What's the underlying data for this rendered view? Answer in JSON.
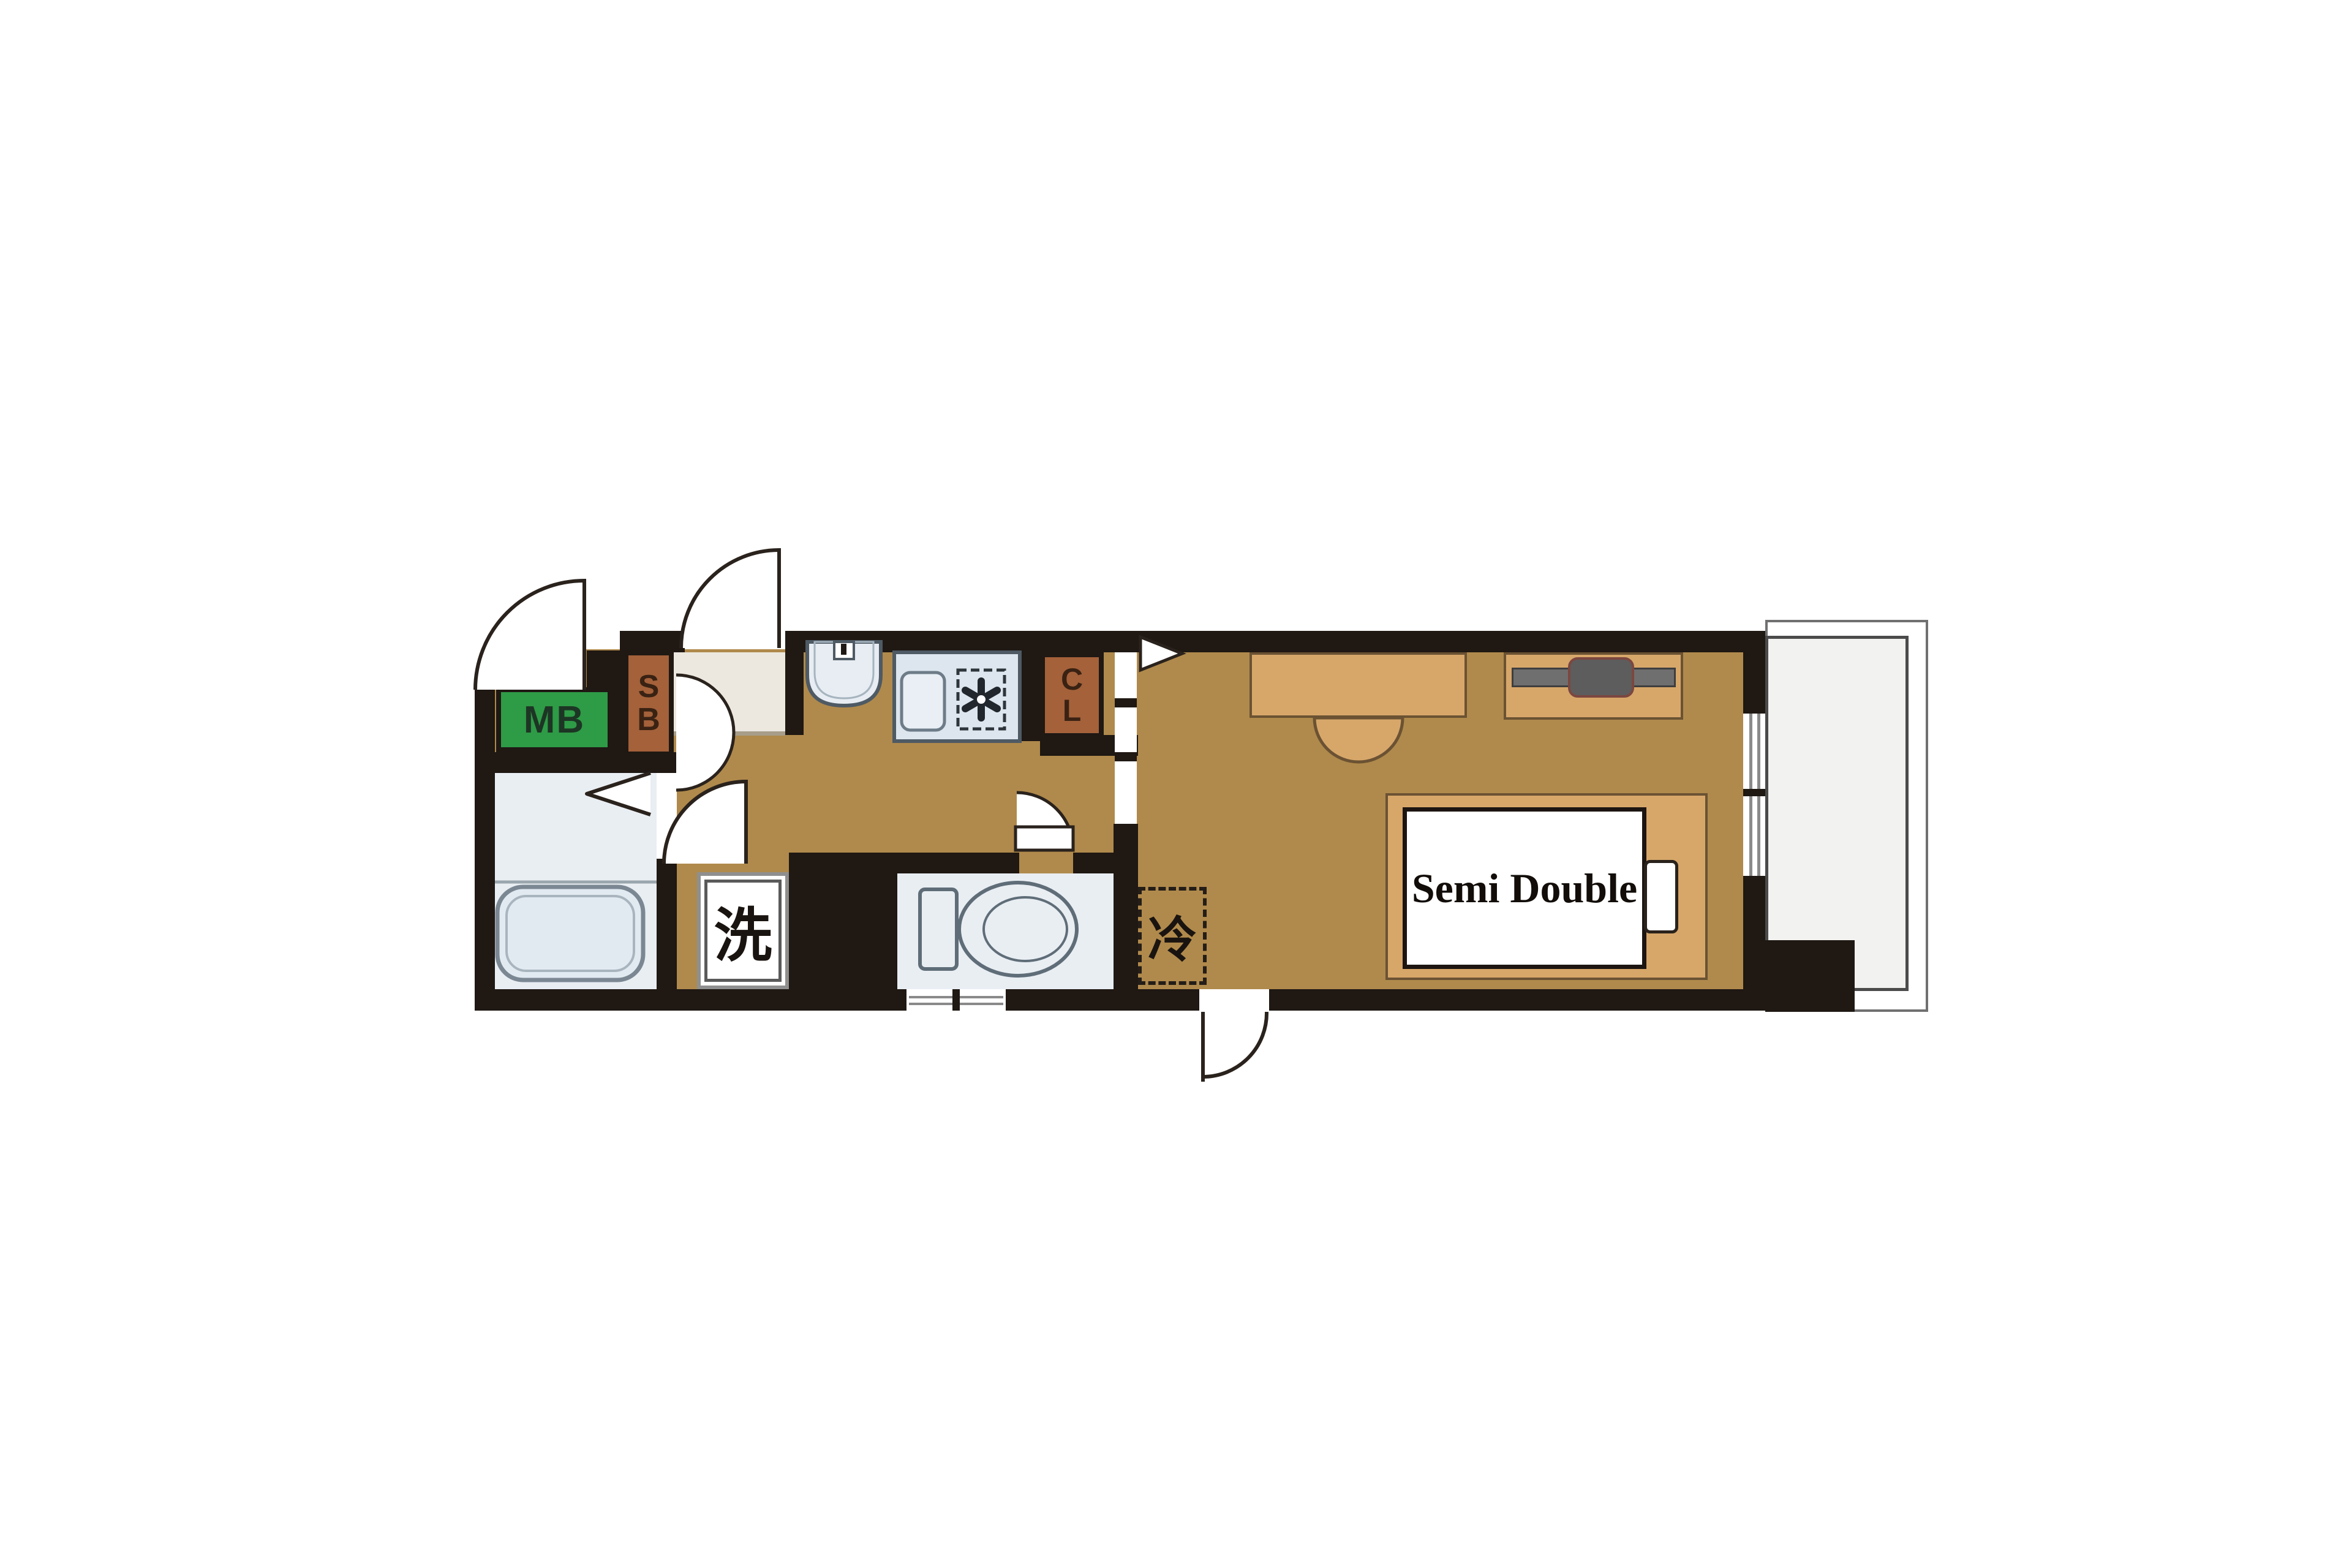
{
  "floorplan": {
    "meter_box_label": "MB",
    "shoe_box": {
      "line1": "S",
      "line2": "B"
    },
    "closet": {
      "line1": "C",
      "line2": "L"
    },
    "washing_machine_label": "洗",
    "refrigerator_label": "冷",
    "bed_label": "Semi Double"
  },
  "colors": {
    "wall": "#1f1813",
    "floor": "#b08a4c",
    "furniture_tan": "#d7a76a",
    "meter_box_green": "#2e9b46",
    "storage_brown": "#a4613a",
    "entrance_beige": "#ece8e0",
    "wet_area_blue": "#e9eef3",
    "fixture_outline": "#5f6d78",
    "balcony_gray": "#f2f2f0",
    "tv_gray": "#6f6f6f"
  },
  "fixtures": [
    "entrance-door-arc",
    "meter-box-door-arc",
    "shoe-box-double-door-arcs",
    "bathroom-folding-door",
    "washroom-door-arc",
    "toilet-door-arc",
    "room-door-triangle",
    "exterior-door-arc",
    "bathtub",
    "washbasin",
    "kitchen-sink",
    "gas-burner",
    "toilet",
    "desk",
    "desk-chair",
    "tv-board",
    "tv",
    "bed",
    "bed-pillow",
    "refrigerator-space",
    "washing-machine-space",
    "window-right-wall",
    "window-bottom-wall",
    "balcony"
  ]
}
